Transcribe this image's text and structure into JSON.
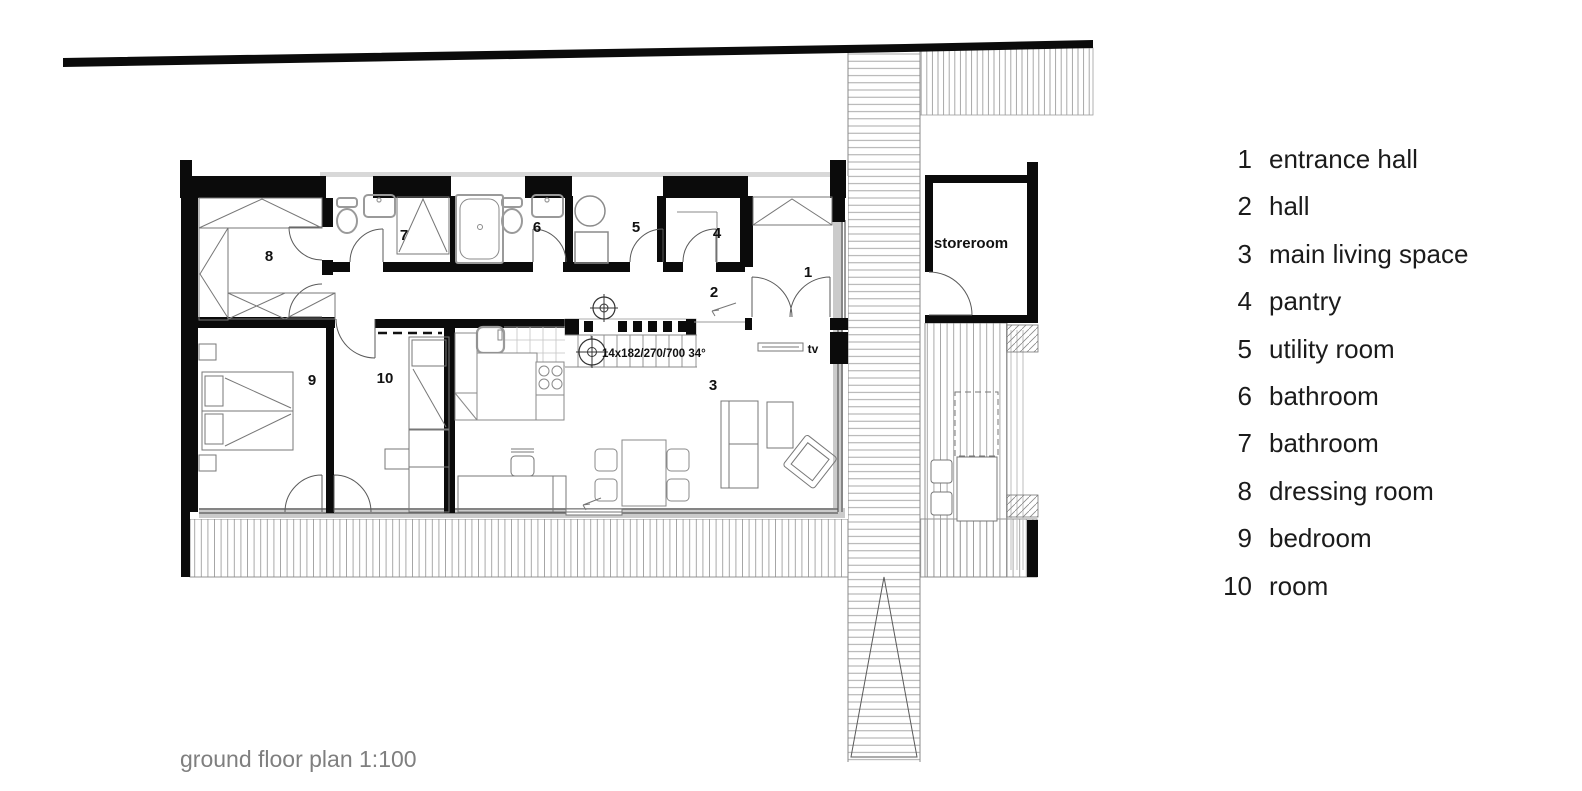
{
  "legend": {
    "items": [
      {
        "num": "1",
        "label": "entrance hall"
      },
      {
        "num": "2",
        "label": "hall"
      },
      {
        "num": "3",
        "label": "main living space"
      },
      {
        "num": "4",
        "label": "pantry"
      },
      {
        "num": "5",
        "label": "utility room"
      },
      {
        "num": "6",
        "label": "bathroom"
      },
      {
        "num": "7",
        "label": "bathroom"
      },
      {
        "num": "8",
        "label": "dressing room"
      },
      {
        "num": "9",
        "label": "bedroom"
      },
      {
        "num": "10",
        "label": "room"
      }
    ]
  },
  "plan": {
    "caption": "ground floor plan 1:100",
    "labels": {
      "storeroom": "storeroom",
      "tv": "tv",
      "stair_note": "14x182/270/700  34°"
    },
    "room_numbers": [
      {
        "n": "1",
        "x": 808,
        "y": 277
      },
      {
        "n": "2",
        "x": 714,
        "y": 297
      },
      {
        "n": "3",
        "x": 713,
        "y": 390
      },
      {
        "n": "4",
        "x": 717,
        "y": 238
      },
      {
        "n": "5",
        "x": 636,
        "y": 232
      },
      {
        "n": "6",
        "x": 537,
        "y": 232
      },
      {
        "n": "7",
        "x": 404,
        "y": 240
      },
      {
        "n": "8",
        "x": 269,
        "y": 261
      },
      {
        "n": "9",
        "x": 312,
        "y": 385
      },
      {
        "n": "10",
        "x": 385,
        "y": 383
      }
    ]
  },
  "colors": {
    "wall_black": "#0b0b0b",
    "window_gray": "#b5b5b5",
    "eave_gray": "#d8d8d8",
    "sill_gray": "#cbcbcb",
    "hatch_gray": "#9f9f9f",
    "line_gray": "#5a5a5a",
    "fixture_gray": "#9a9a9a",
    "text_black": "#1b1b1b",
    "caption_gray": "#7f7f7f"
  }
}
